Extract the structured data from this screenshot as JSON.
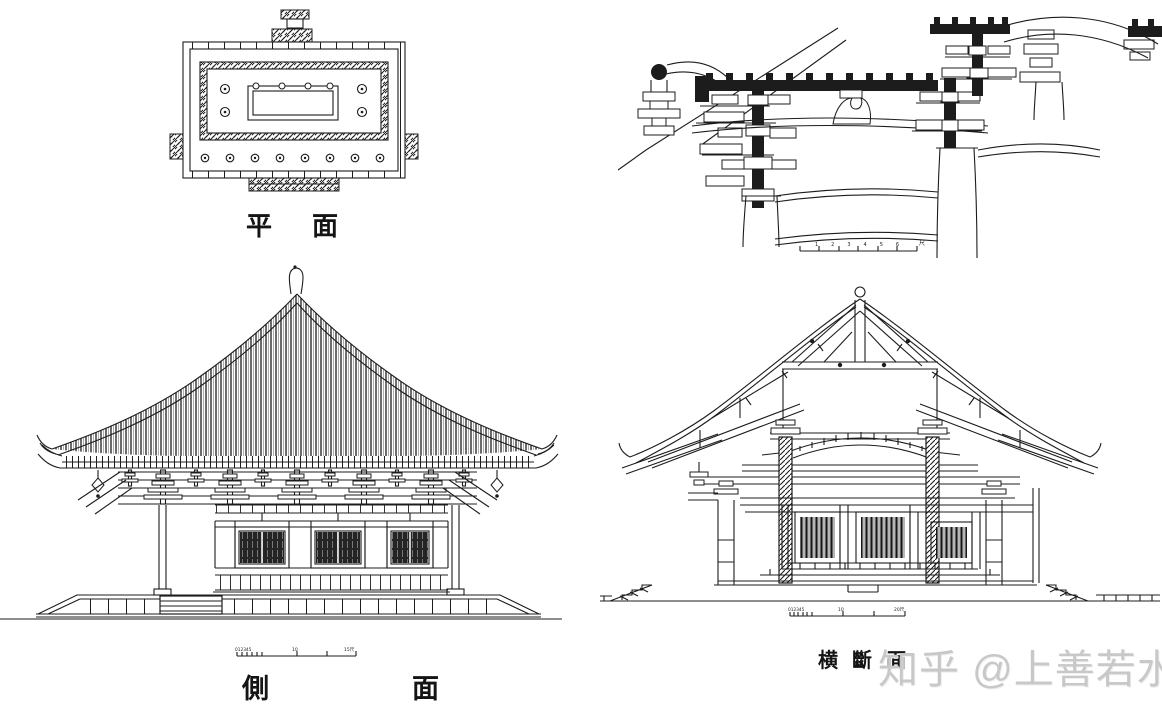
{
  "page": {
    "background_color": "#ffffff",
    "ink_color": "#1c1c1c",
    "watermark_color": "#c8c8c8"
  },
  "views": {
    "plan": {
      "title": "平面"
    },
    "bracket_detail": {
      "scale_numbers": "123456",
      "scale_unit": "尺"
    },
    "side_elevation": {
      "title": "側面",
      "scale_minor": "012345",
      "scale_mid": "10",
      "scale_end": "15尺"
    },
    "cross_section": {
      "title": "横斷面",
      "scale_minor": "012345",
      "scale_mid": "10",
      "scale_end": "20尺"
    }
  },
  "watermark": {
    "text": "知乎 @上善若水"
  }
}
